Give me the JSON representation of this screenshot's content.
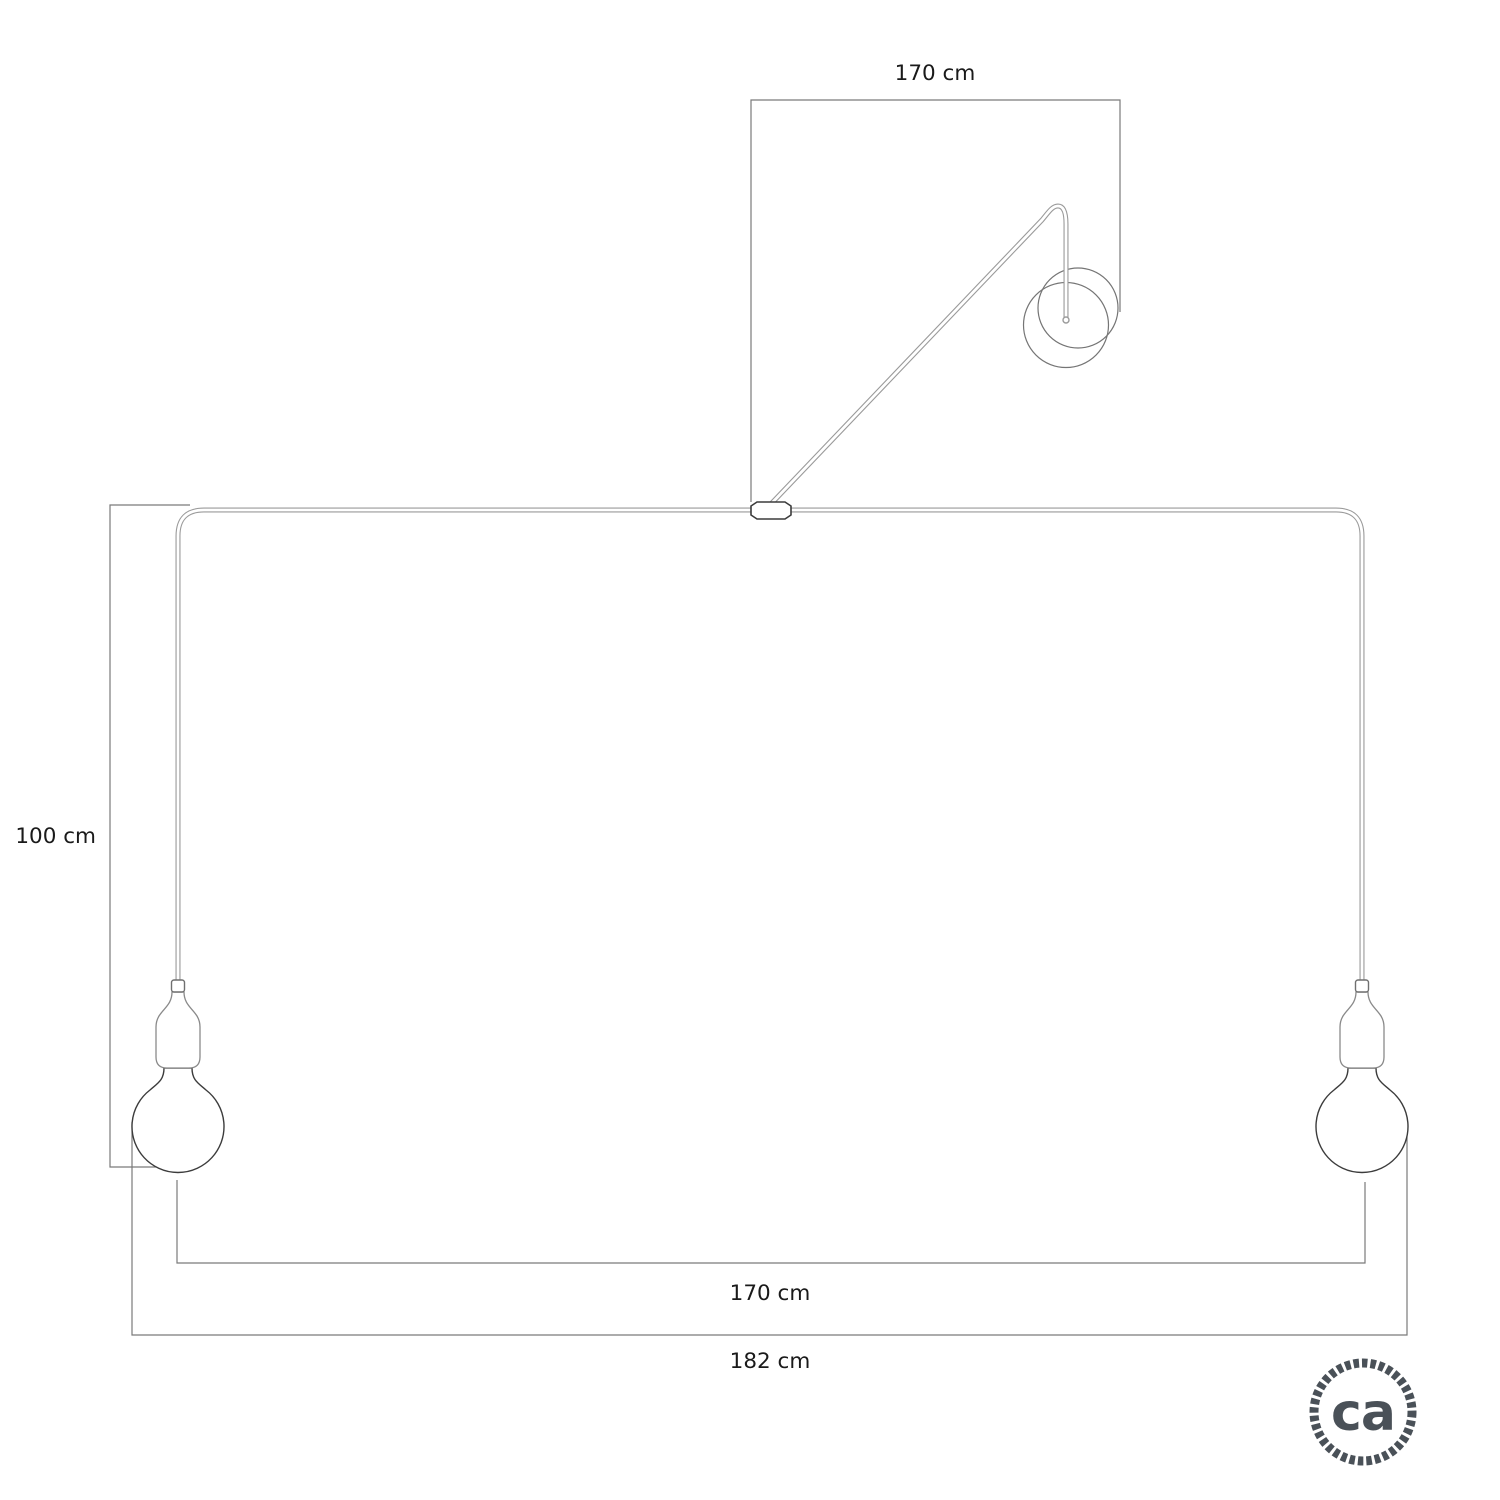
{
  "diagram": {
    "labels": {
      "top_cable_length": "170 cm",
      "drop_height": "100 cm",
      "pendant_spread": "170 cm",
      "total_width": "182 cm"
    },
    "components": {
      "wall_cup": "wall ceiling-rose with looped cable",
      "center_connector": "central cable clamp",
      "pendants": "two pendant sockets with globe bulbs"
    },
    "colors": {
      "background": "#ffffff",
      "dimension_line": "#7a7a7a",
      "cable": "#9a9a9a",
      "fixture_outline": "#3c3c3c",
      "socket_outline": "#8a8a8a",
      "text": "#1a1a1a",
      "logo": "#4a5158"
    }
  },
  "logo": {
    "text": "ca"
  }
}
